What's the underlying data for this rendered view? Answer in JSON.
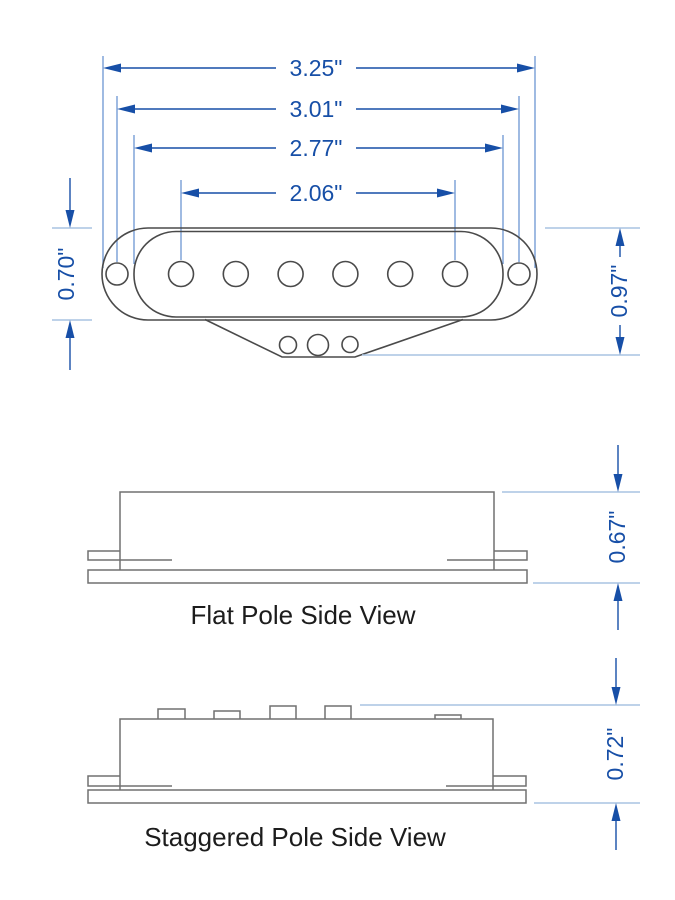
{
  "drawing": {
    "type": "technical-dimension-drawing",
    "subject": "single-coil guitar pickup",
    "palette": {
      "dimension_blue": "#174fa7",
      "extension_blue_medium": "#6c96d2",
      "extension_blue_light": "#a9c4e2",
      "outline_gray_top_view": "#4a4a4a",
      "outline_gray_side_view": "#707070",
      "label_black": "#1c1c1c",
      "background": "#ffffff"
    },
    "icons": {
      "arrowhead": "dimension-arrowhead-icon"
    },
    "top_view": {
      "dim_overall_width": "3.25\"",
      "dim_mount_hole_spacing": "3.01\"",
      "dim_bobbin_width": "2.77\"",
      "dim_pole_span": "2.06\"",
      "dim_body_depth": "0.70\"",
      "dim_overall_depth": "0.97\"",
      "pole_count": 6,
      "mount_hole_count": 2,
      "flange_hole_count": 3
    },
    "flat_pole_view": {
      "label": "Flat Pole Side View",
      "dim_height": "0.67\""
    },
    "staggered_pole_view": {
      "label": "Staggered Pole Side View",
      "dim_height": "0.72\""
    }
  }
}
